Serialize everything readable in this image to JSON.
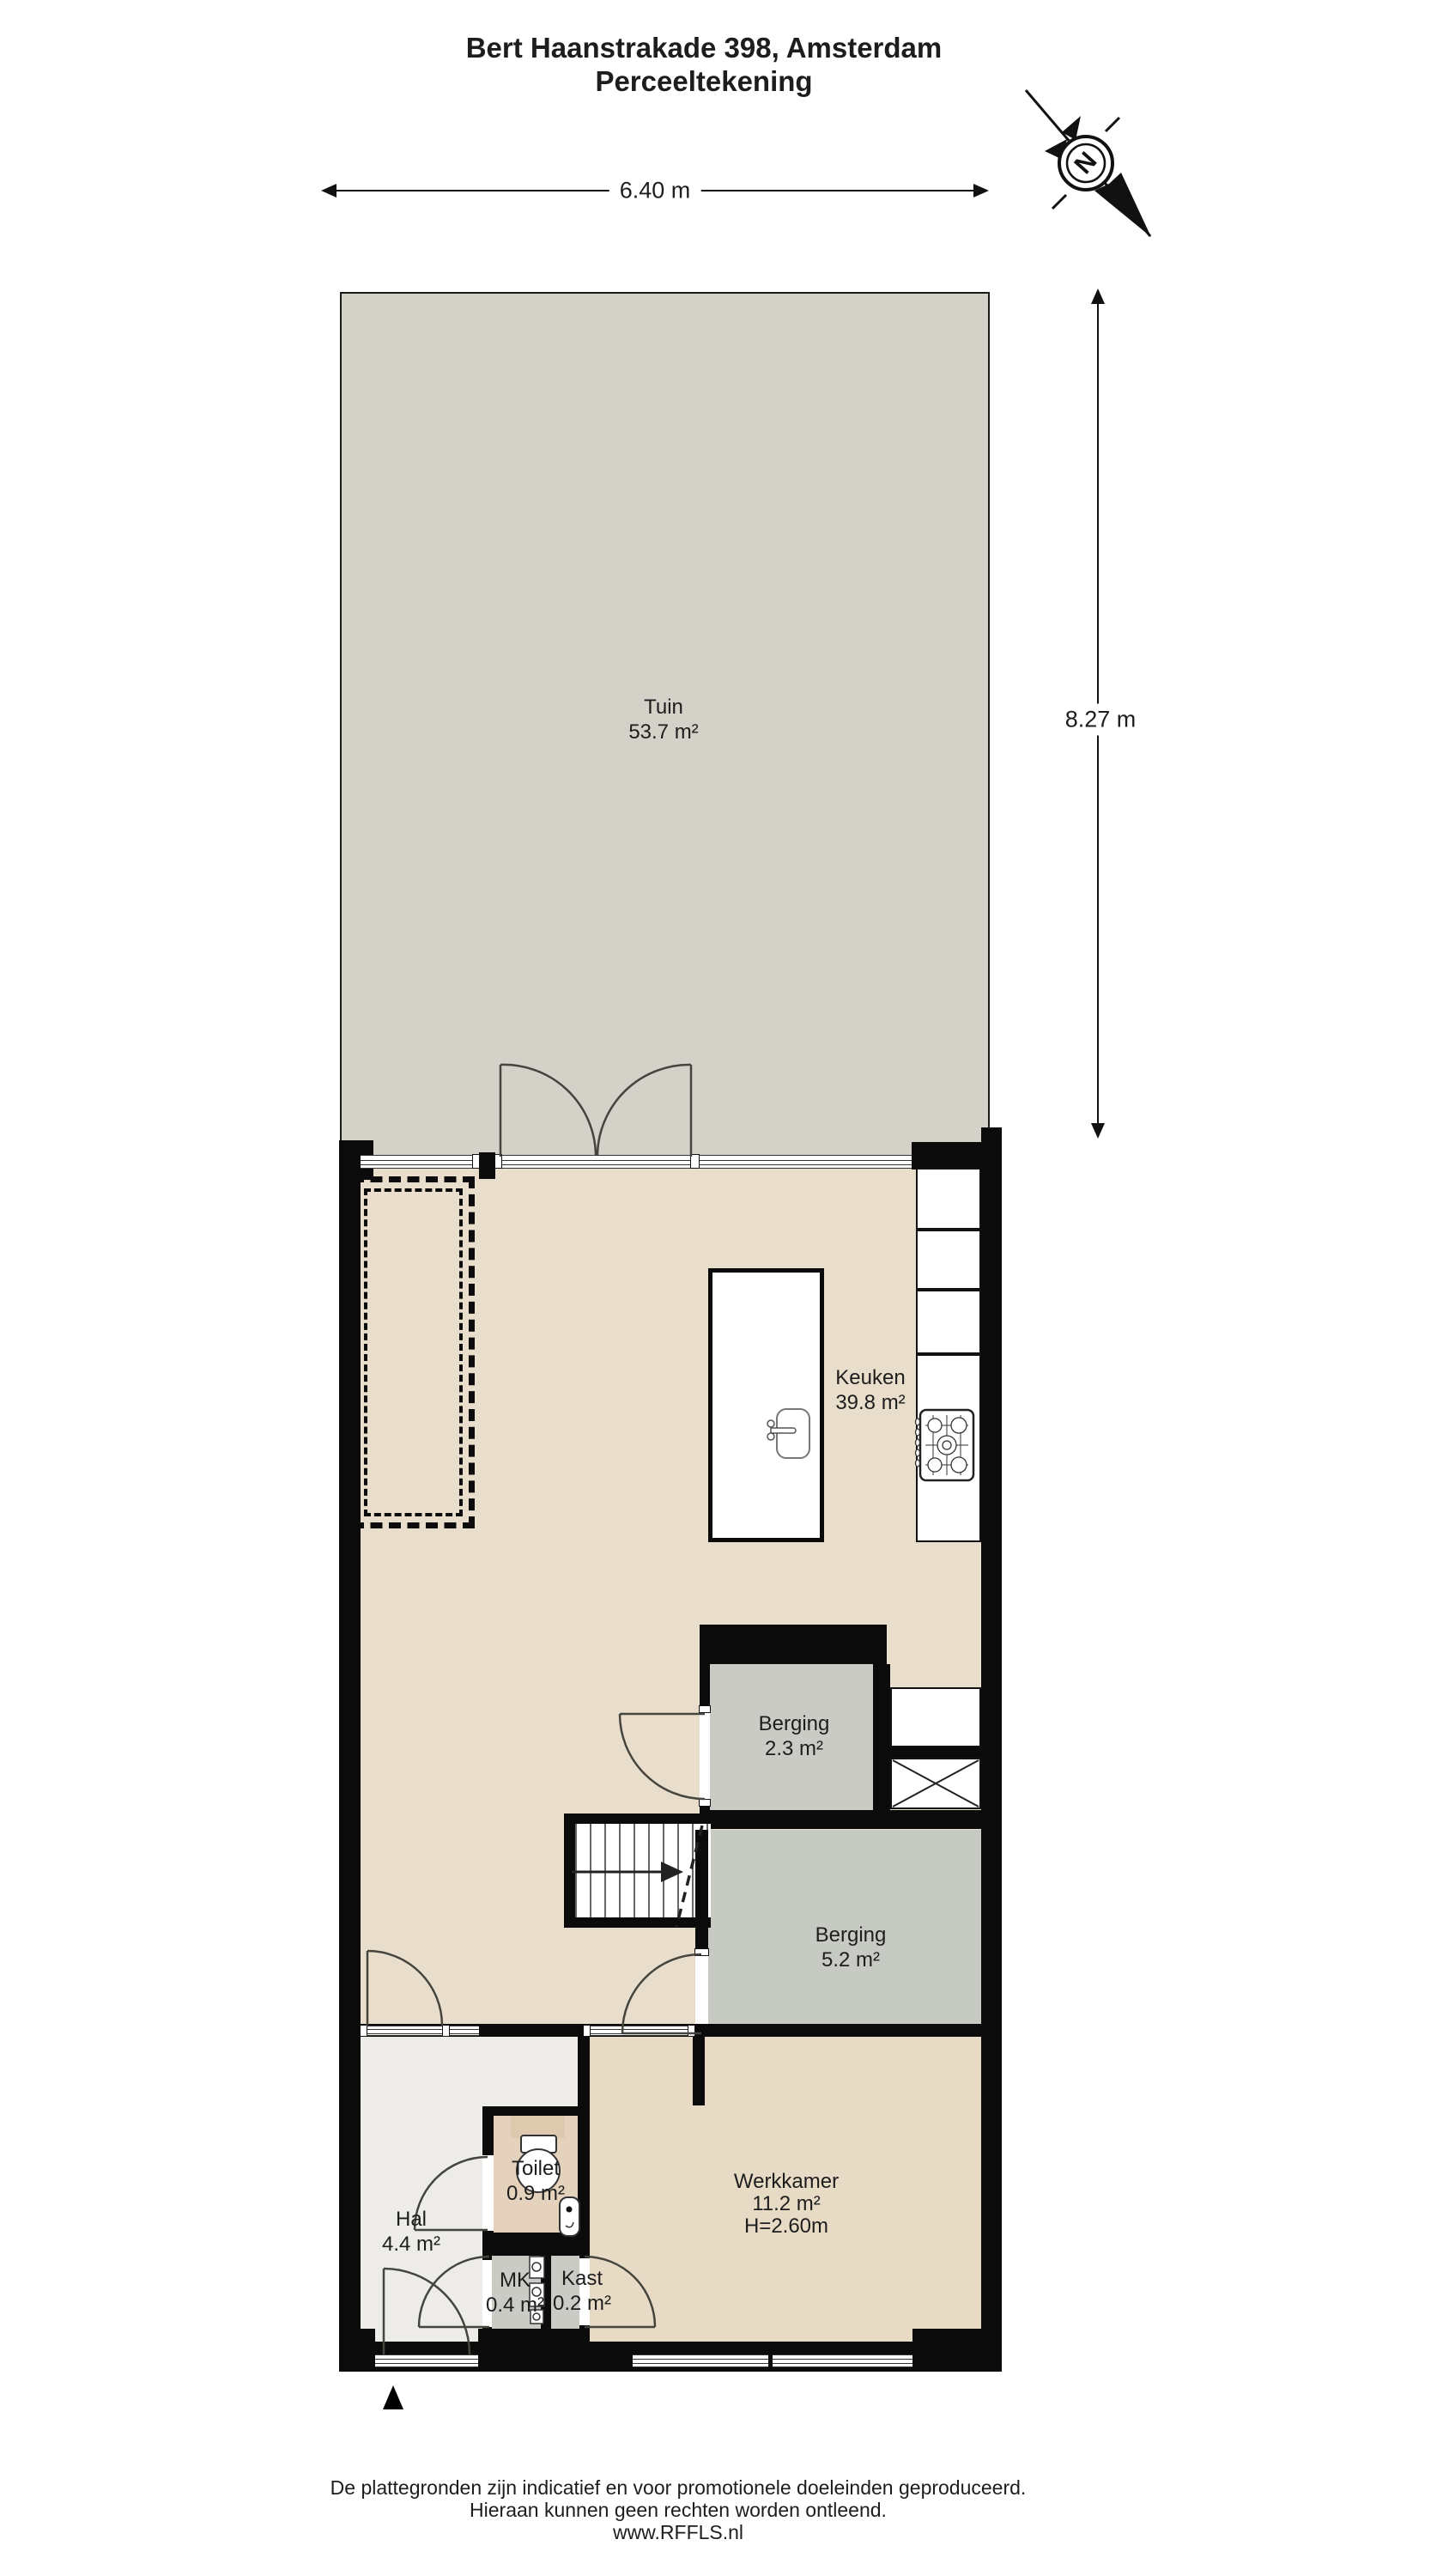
{
  "title": {
    "line1": "Bert Haanstrakade 398, Amsterdam",
    "line2": "Perceeltekening"
  },
  "compass": {
    "label": "N"
  },
  "dimensions": {
    "width": "6.40 m",
    "height": "8.27 m"
  },
  "rooms": [
    {
      "id": "tuin",
      "name": "Tuin",
      "area": "53.7 m²"
    },
    {
      "id": "keuken",
      "name": "Keuken",
      "area": "39.8 m²"
    },
    {
      "id": "berging-klein",
      "name": "Berging",
      "area": "2.3 m²"
    },
    {
      "id": "berging-groot",
      "name": "Berging",
      "area": "5.2 m²"
    },
    {
      "id": "hal",
      "name": "Hal",
      "area": "4.4 m²"
    },
    {
      "id": "toilet",
      "name": "Toilet",
      "area": "0.9 m²"
    },
    {
      "id": "mk",
      "name": "MK",
      "area": "0.4 m²"
    },
    {
      "id": "kast",
      "name": "Kast",
      "area": "0.2 m²"
    },
    {
      "id": "werkkamer",
      "name": "Werkkamer",
      "area": "11.2 m²",
      "ceiling_height": "H=2.60m"
    }
  ],
  "footer": {
    "line1": "De plattegronden zijn indicatief en voor promotionele doeleinden geproduceerd.",
    "line2": "Hieraan kunnen geen rechten worden ontleend.",
    "line3": "www.RFFLS.nl"
  },
  "colors": {
    "wall": "#0b0b0b",
    "garden": "#d3d1c8",
    "floor_main": "#e8decb",
    "floor_work": "#e7dbc6",
    "floor_toilet": "#e5d2bc",
    "floor_storage": "#c9cbc4",
    "floor_storage_large": "#c7cac3",
    "floor_hall": "#edece8",
    "background": "#ffffff"
  }
}
